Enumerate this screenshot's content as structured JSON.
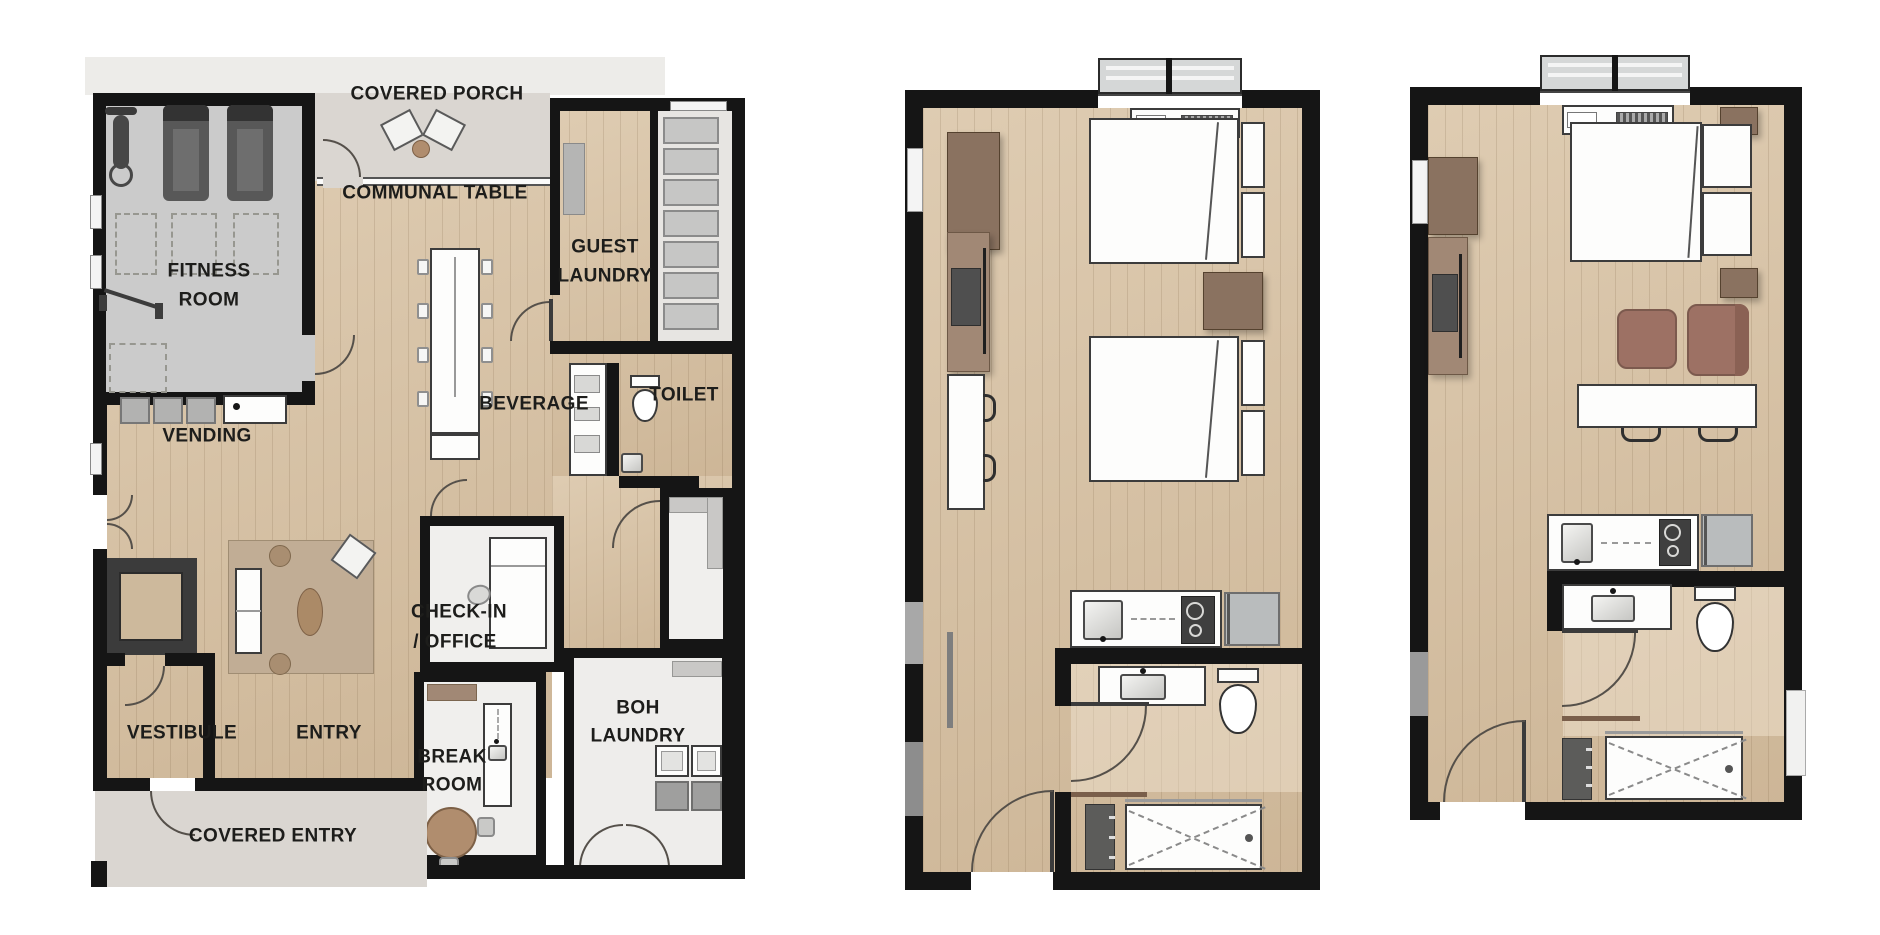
{
  "canvas": {
    "width": 1880,
    "height": 935,
    "background": "#ffffff"
  },
  "palette": {
    "wall": "#151515",
    "floor_wood": "#d8c2a3",
    "plank_line": "rgba(120,95,65,0.18)",
    "concrete": "#dad6d1",
    "fitness_floor": "#cbcbcb",
    "service_floor": "#f0efed",
    "corridor_floor": "#e7e5e2",
    "rug": "#c1ad95",
    "wood_dark": "#8a7260",
    "wood_mid": "#a18875",
    "wood_table": "#b08d6e",
    "upholstery": "#9d7164",
    "upholstery_dark": "#8a6154",
    "fixture_white": "#fdfdfc",
    "appliance_gray": "#c2c2c1",
    "stainless": "#b9bcbd",
    "tv_dark": "#4f4f4f",
    "machine_dark": "#3f3f3f",
    "closet_dark": "#5c5c5a",
    "label_color": "#1d1d1b"
  },
  "community_plan": {
    "labels": {
      "covered_porch": "COVERED PORCH",
      "communal_table": "COMMUNAL TABLE",
      "fitness_line1": "FITNESS",
      "fitness_line2": "ROOM",
      "guest_laundry_line1": "GUEST",
      "guest_laundry_line2": "LAUNDRY",
      "beverage": "BEVERAGE",
      "toilet": "TOILET",
      "vending": "VENDING",
      "check_in_line1": "CHECK-IN",
      "check_in_line2": "/ OFFICE",
      "vestibule": "VESTIBULE",
      "entry": "ENTRY",
      "break_line1": "BREAK",
      "break_line2": "ROOM",
      "boh_line1": "BOH",
      "boh_line2": "LAUNDRY",
      "covered_entry": "COVERED ENTRY"
    }
  },
  "guestroom_double_queen": {
    "furniture": [
      "window",
      "ptac-unit",
      "dresser",
      "tv-console",
      "tv",
      "bar-counter",
      "stool",
      "stool",
      "queen-bed-1",
      "queen-bed-2",
      "nightstand",
      "kitchenette-sink",
      "cooktop",
      "mini-fridge",
      "vanity-sink",
      "toilet",
      "shower",
      "closet-shelves",
      "entry-door"
    ]
  },
  "guestroom_king": {
    "furniture": [
      "window",
      "ptac-unit",
      "dresser",
      "tv-console",
      "tv",
      "king-bed",
      "nightstand",
      "nightstand",
      "lounge-chair",
      "lounge-chair",
      "bar-table",
      "stool",
      "stool",
      "kitchenette-sink",
      "cooktop",
      "mini-fridge",
      "vanity-sink",
      "toilet",
      "shower",
      "closet-shelves",
      "entry-door"
    ]
  }
}
